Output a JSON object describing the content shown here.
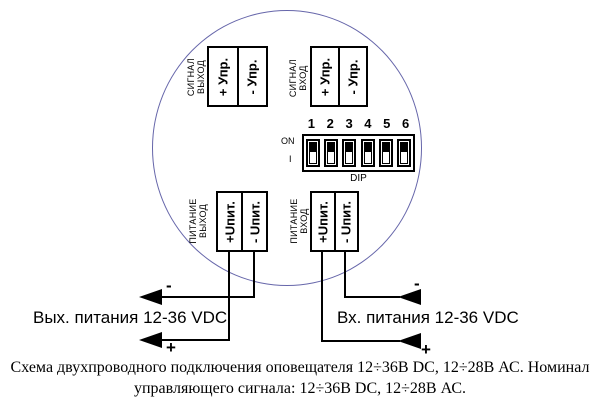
{
  "device": {
    "blocks": {
      "signal_out": {
        "label": "СИГНАЛ\nВЫХОД",
        "plus": "+ Упр.",
        "minus": "- Упр."
      },
      "signal_in": {
        "label": "СИГНАЛ\nВХОД",
        "plus": "+ Упр.",
        "minus": "- Упр."
      },
      "power_out": {
        "label": "ПИТАНИЕ\nВЫХОД",
        "plus": "+Uпит.",
        "minus": "- Uпит."
      },
      "power_in": {
        "label": "ПИТАНИЕ\nВХОД",
        "plus": "+Uпит.",
        "minus": "- Uпит."
      }
    },
    "dip": {
      "numbers": [
        "1",
        "2",
        "3",
        "4",
        "5",
        "6"
      ],
      "on_label": "ON",
      "i_label": "I",
      "name_label": "DIP",
      "state": [
        "on",
        "on",
        "on",
        "on",
        "on",
        "on"
      ]
    }
  },
  "wiring": {
    "out": {
      "label": "Вых. питания 12-36 VDC",
      "minus": "-",
      "plus": "+"
    },
    "in": {
      "label": "Вх. питания 12-36 VDC",
      "minus": "-",
      "plus": "+"
    }
  },
  "caption": {
    "line1": "Схема двухпроводного подключения оповещателя 12÷36В DC, 12÷28В АС. Номинал",
    "line2": "управляющего сигнала: 12÷36В DC, 12÷28В АС."
  },
  "colors": {
    "circle": "#6666aa",
    "wire": "#000000"
  }
}
